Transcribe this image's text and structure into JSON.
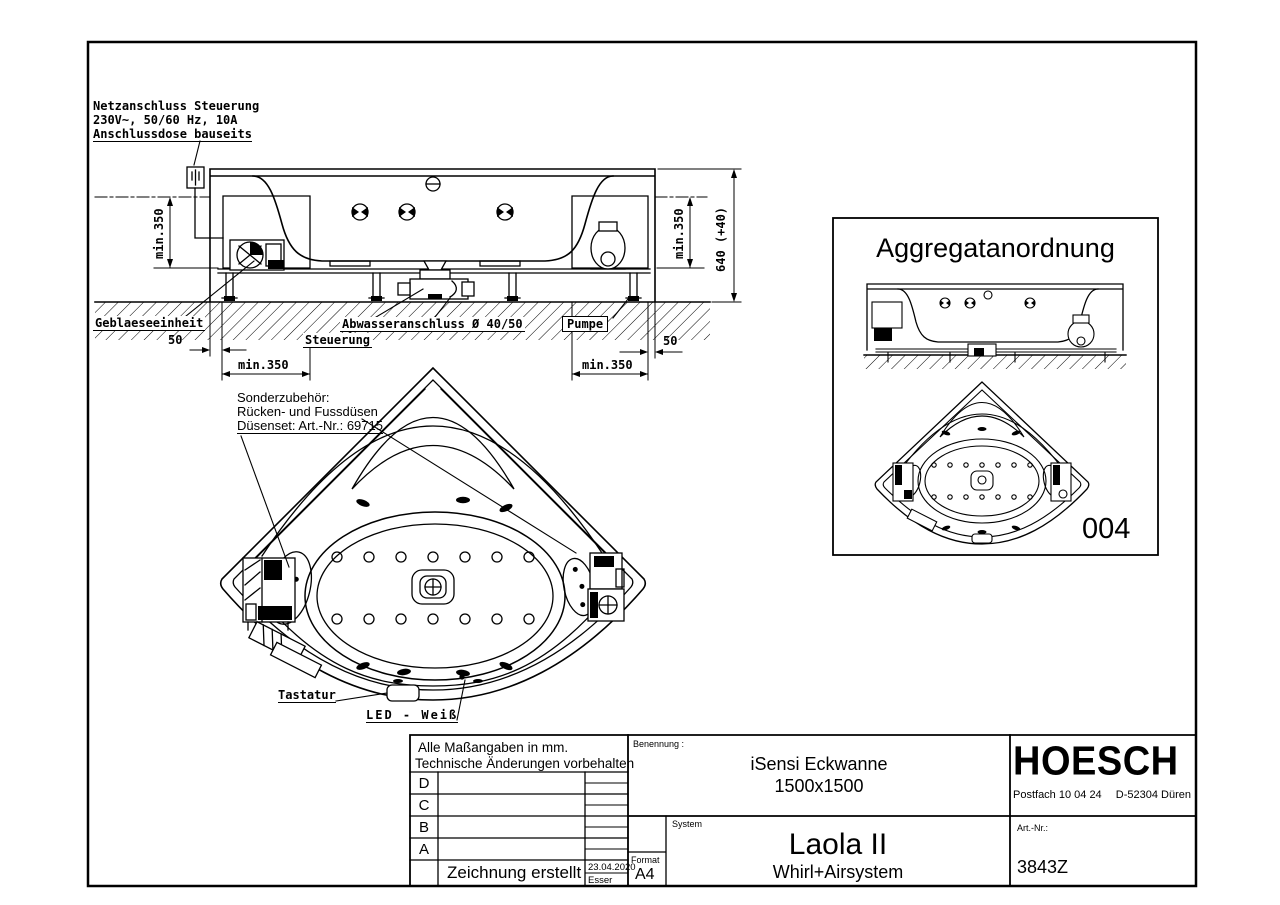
{
  "colors": {
    "ink": "#000000",
    "paper": "#ffffff"
  },
  "elevation": {
    "netzanschluss": {
      "line1": "Netzanschluss Steuerung",
      "line2": "230V~, 50/60 Hz, 10A",
      "line3": "Anschlussdose bauseits"
    },
    "labels": {
      "geblaeseeinheit": "Geblaeseeinheit",
      "steuerung": "Steuerung",
      "abwasseranschluss": "Abwasseranschluss Ø 40/50",
      "pumpe": "Pumpe"
    },
    "dimensions": {
      "min_left_vertical": "min.350",
      "min_right_vertical": "min.350",
      "min_bottom_left": "min.350",
      "min_bottom_right": "min.350",
      "overall_height": "640 (+40)",
      "gap_left": "50",
      "gap_right": "50"
    }
  },
  "plan": {
    "sonderzubehoer": {
      "line1": "Sonderzubehör:",
      "line2": "Rücken- und Fussdüsen",
      "line3": "Düsenset: Art.-Nr.: 69715"
    },
    "labels": {
      "tastatur": "Tastatur",
      "led": "LED - Weiß"
    }
  },
  "aggregat": {
    "title": "Aggregatanordnung",
    "position_code": "004"
  },
  "title_block": {
    "note1": "Alle Maßangaben in mm.",
    "note2": "Technische Änderungen vorbehalten",
    "revisions": [
      {
        "letter": "D"
      },
      {
        "letter": "C"
      },
      {
        "letter": "B"
      },
      {
        "letter": "A"
      }
    ],
    "created_label": "Zeichnung erstellt",
    "created_date": "23.04.2020",
    "created_by": "Esser",
    "benennung_label": "Benennung :",
    "name_line1": "iSensi Eckwanne",
    "name_line2": "1500x1500",
    "system_label": "System",
    "system_name": "Laola II",
    "system_subtitle": "Whirl+Airsystem",
    "format_label": "Format",
    "format_value": "A4",
    "brand": "HOESCH",
    "address_left": "Postfach 10 04 24",
    "address_right": "D-52304 Düren",
    "artnr_label": "Art.-Nr.:",
    "artnr_value": "3843Z"
  }
}
